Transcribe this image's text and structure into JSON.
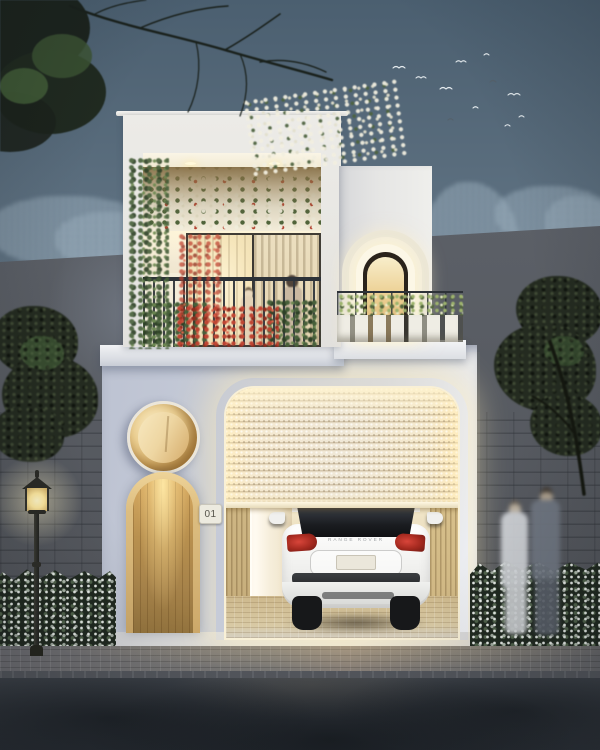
{
  "scene": {
    "title": "Modern white two-storey house at dusk with glowing garage",
    "house_number_plate": "01",
    "car_badge_text": "RANGE ROVER",
    "palette": {
      "sky_top": "#56697a",
      "sky_bottom": "#9aa7b0",
      "distant_trees": "#8fa4b2",
      "boundary_wall": "#565a61",
      "upper_facade": "#ecebe7",
      "lower_facade": "#c7ccd9",
      "warm_light": "#f7e6bb",
      "door_wood": "#b8904f",
      "door_frame_wood": "#dcbd80",
      "porthole_wood": "#cfa660",
      "foliage_dark": "#242b20",
      "flower_white": "#f2efe0",
      "flower_red": "#b4402e",
      "railing_dark": "#32373d",
      "car_body": "#f3f3f1",
      "taillight_red": "#a4291f",
      "sidewalk": "#7b7976",
      "road": "#363b42"
    }
  }
}
